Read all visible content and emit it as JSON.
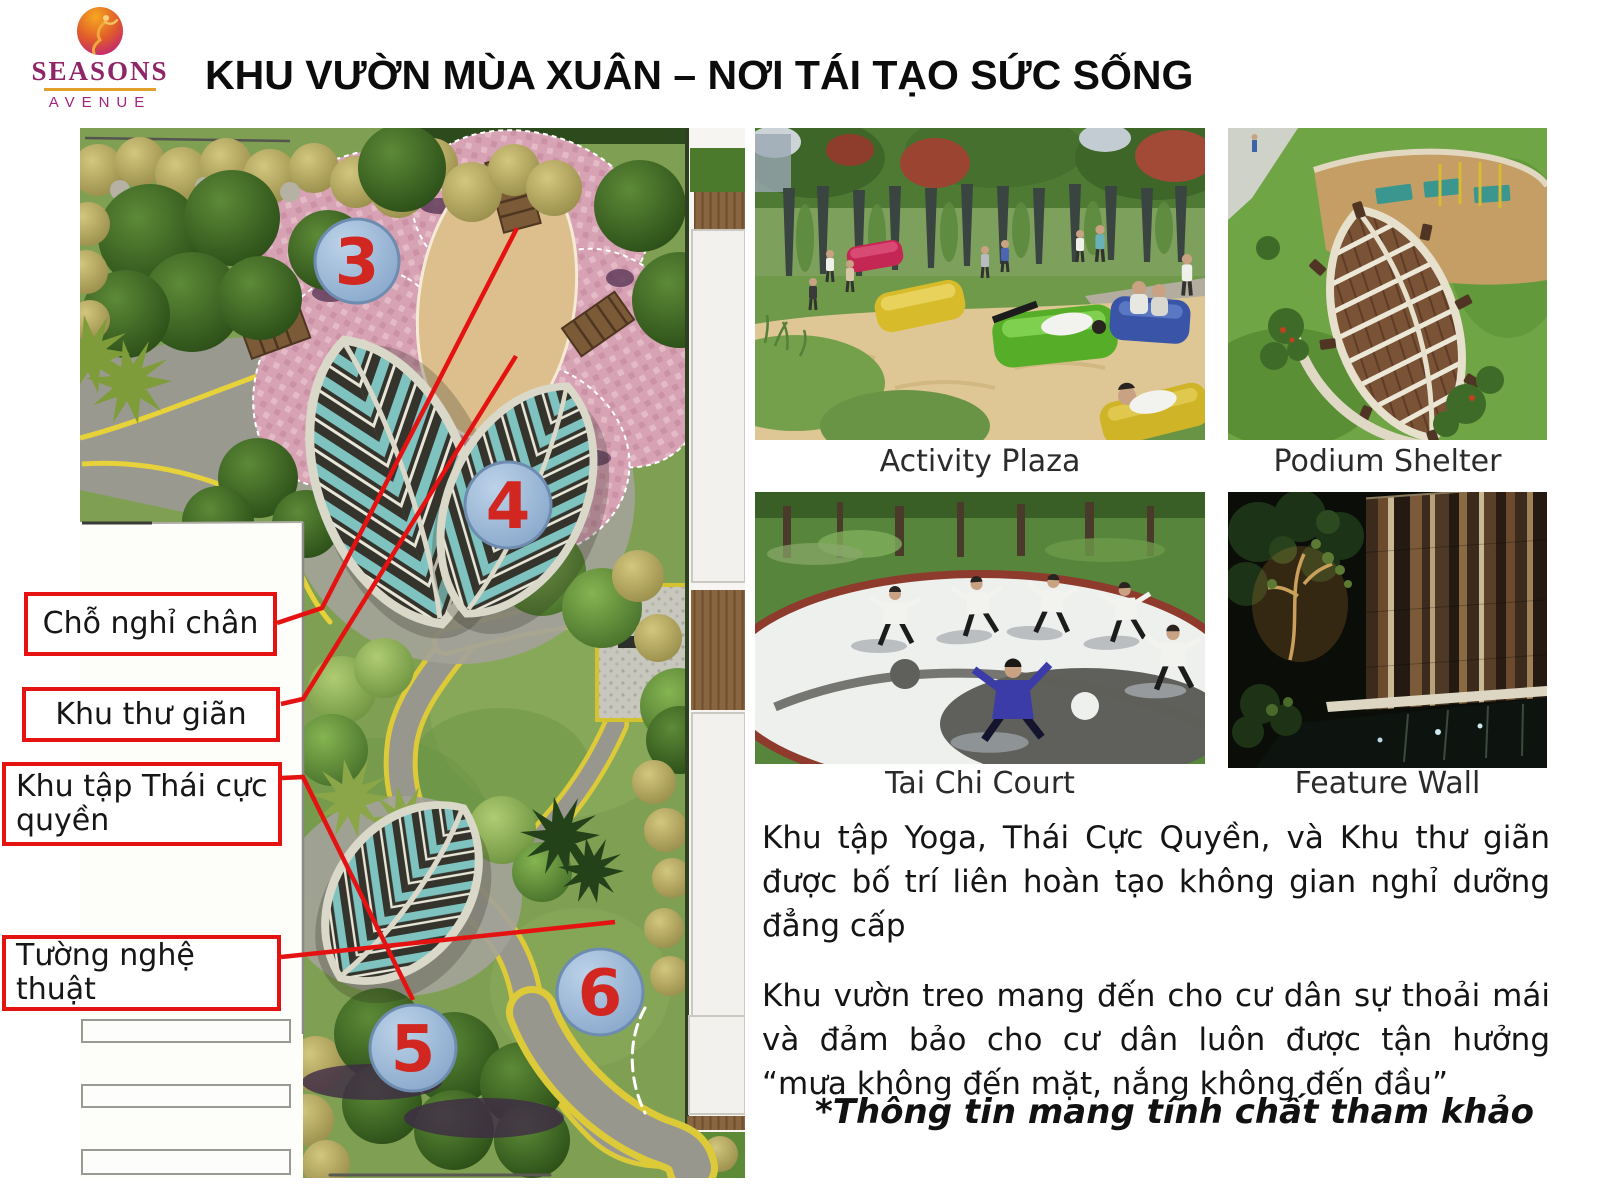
{
  "title": "KHU VƯỜN MÙA XUÂN – NƠI TÁI TẠO SỨC SỐNG",
  "logo": {
    "brand": "SEASONS",
    "subtitle": "AVENUE"
  },
  "map": {
    "markers": [
      {
        "number": "3"
      },
      {
        "number": "4"
      },
      {
        "number": "5"
      },
      {
        "number": "6"
      }
    ],
    "labels": [
      {
        "text": "Chỗ nghỉ chân"
      },
      {
        "text": "Khu thư giãn"
      },
      {
        "text": "Khu tập Thái cực quyền"
      },
      {
        "text": "Tường nghệ thuật"
      }
    ]
  },
  "photos": [
    {
      "caption": "Activity Plaza"
    },
    {
      "caption": "Podium Shelter"
    },
    {
      "caption": "Tai Chi Court"
    },
    {
      "caption": "Feature Wall"
    }
  ],
  "content": {
    "paragraphs": [
      "Khu tập Yoga, Thái Cực Quyền, và Khu thư giãn được bố trí liên hoàn tạo không gian nghỉ dưỡng đẳng cấp",
      "Khu vườn treo mang đến cho cư dân sự thoải mái và đảm bảo cho cư dân luôn được tận hưởng “mưa không đến mặt, nắng không đến đầu”"
    ],
    "disclaimer": "*Thông tin mang tính chất tham khảo"
  },
  "colors": {
    "annotation_red": "#e51212",
    "marker_fill": "#9ab6d8",
    "marker_number": "#d22620",
    "logo_magenta": "#8e2566",
    "logo_gold": "#e2a02c"
  }
}
